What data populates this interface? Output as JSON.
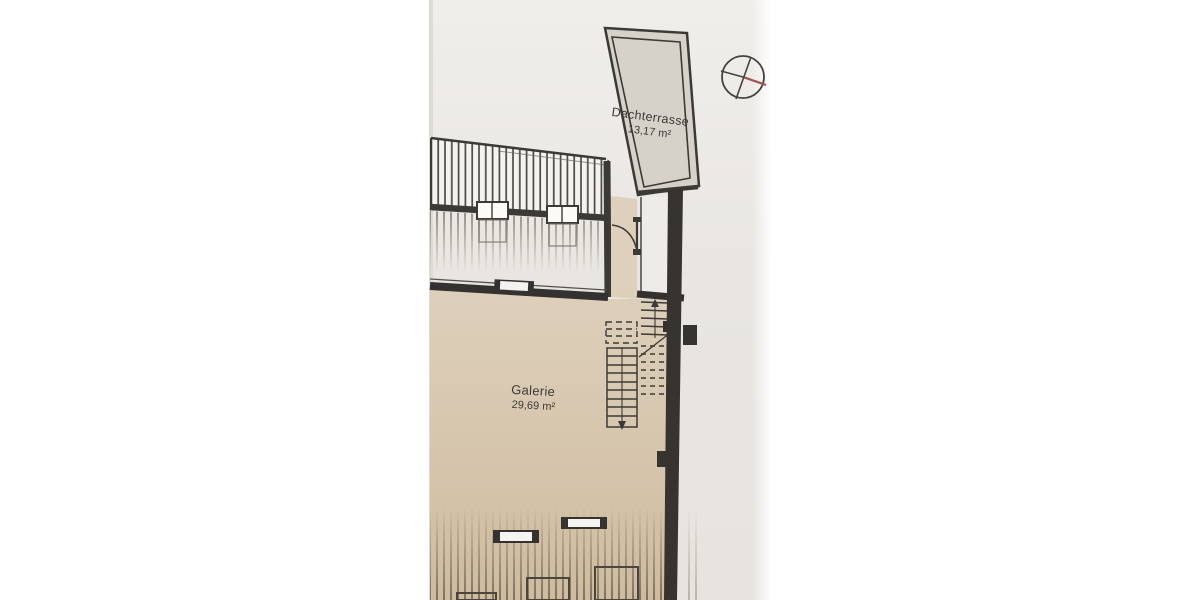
{
  "floor_plan": {
    "rooms": [
      {
        "name": "Dachterrasse",
        "area": "13,17 m²"
      },
      {
        "name": "Galerie",
        "area": "29,69 m²"
      }
    ]
  },
  "icons": {
    "north_indicator": "compass-crosshair-circle"
  },
  "colors": {
    "canvas_white": "#ffffff",
    "paper_gray": "#eae7e3",
    "floor_beige": "#d9c9b1",
    "terrace_gray": "#d6d2c9",
    "wall_dark": "#37342f",
    "north_red": "#9c5348"
  }
}
